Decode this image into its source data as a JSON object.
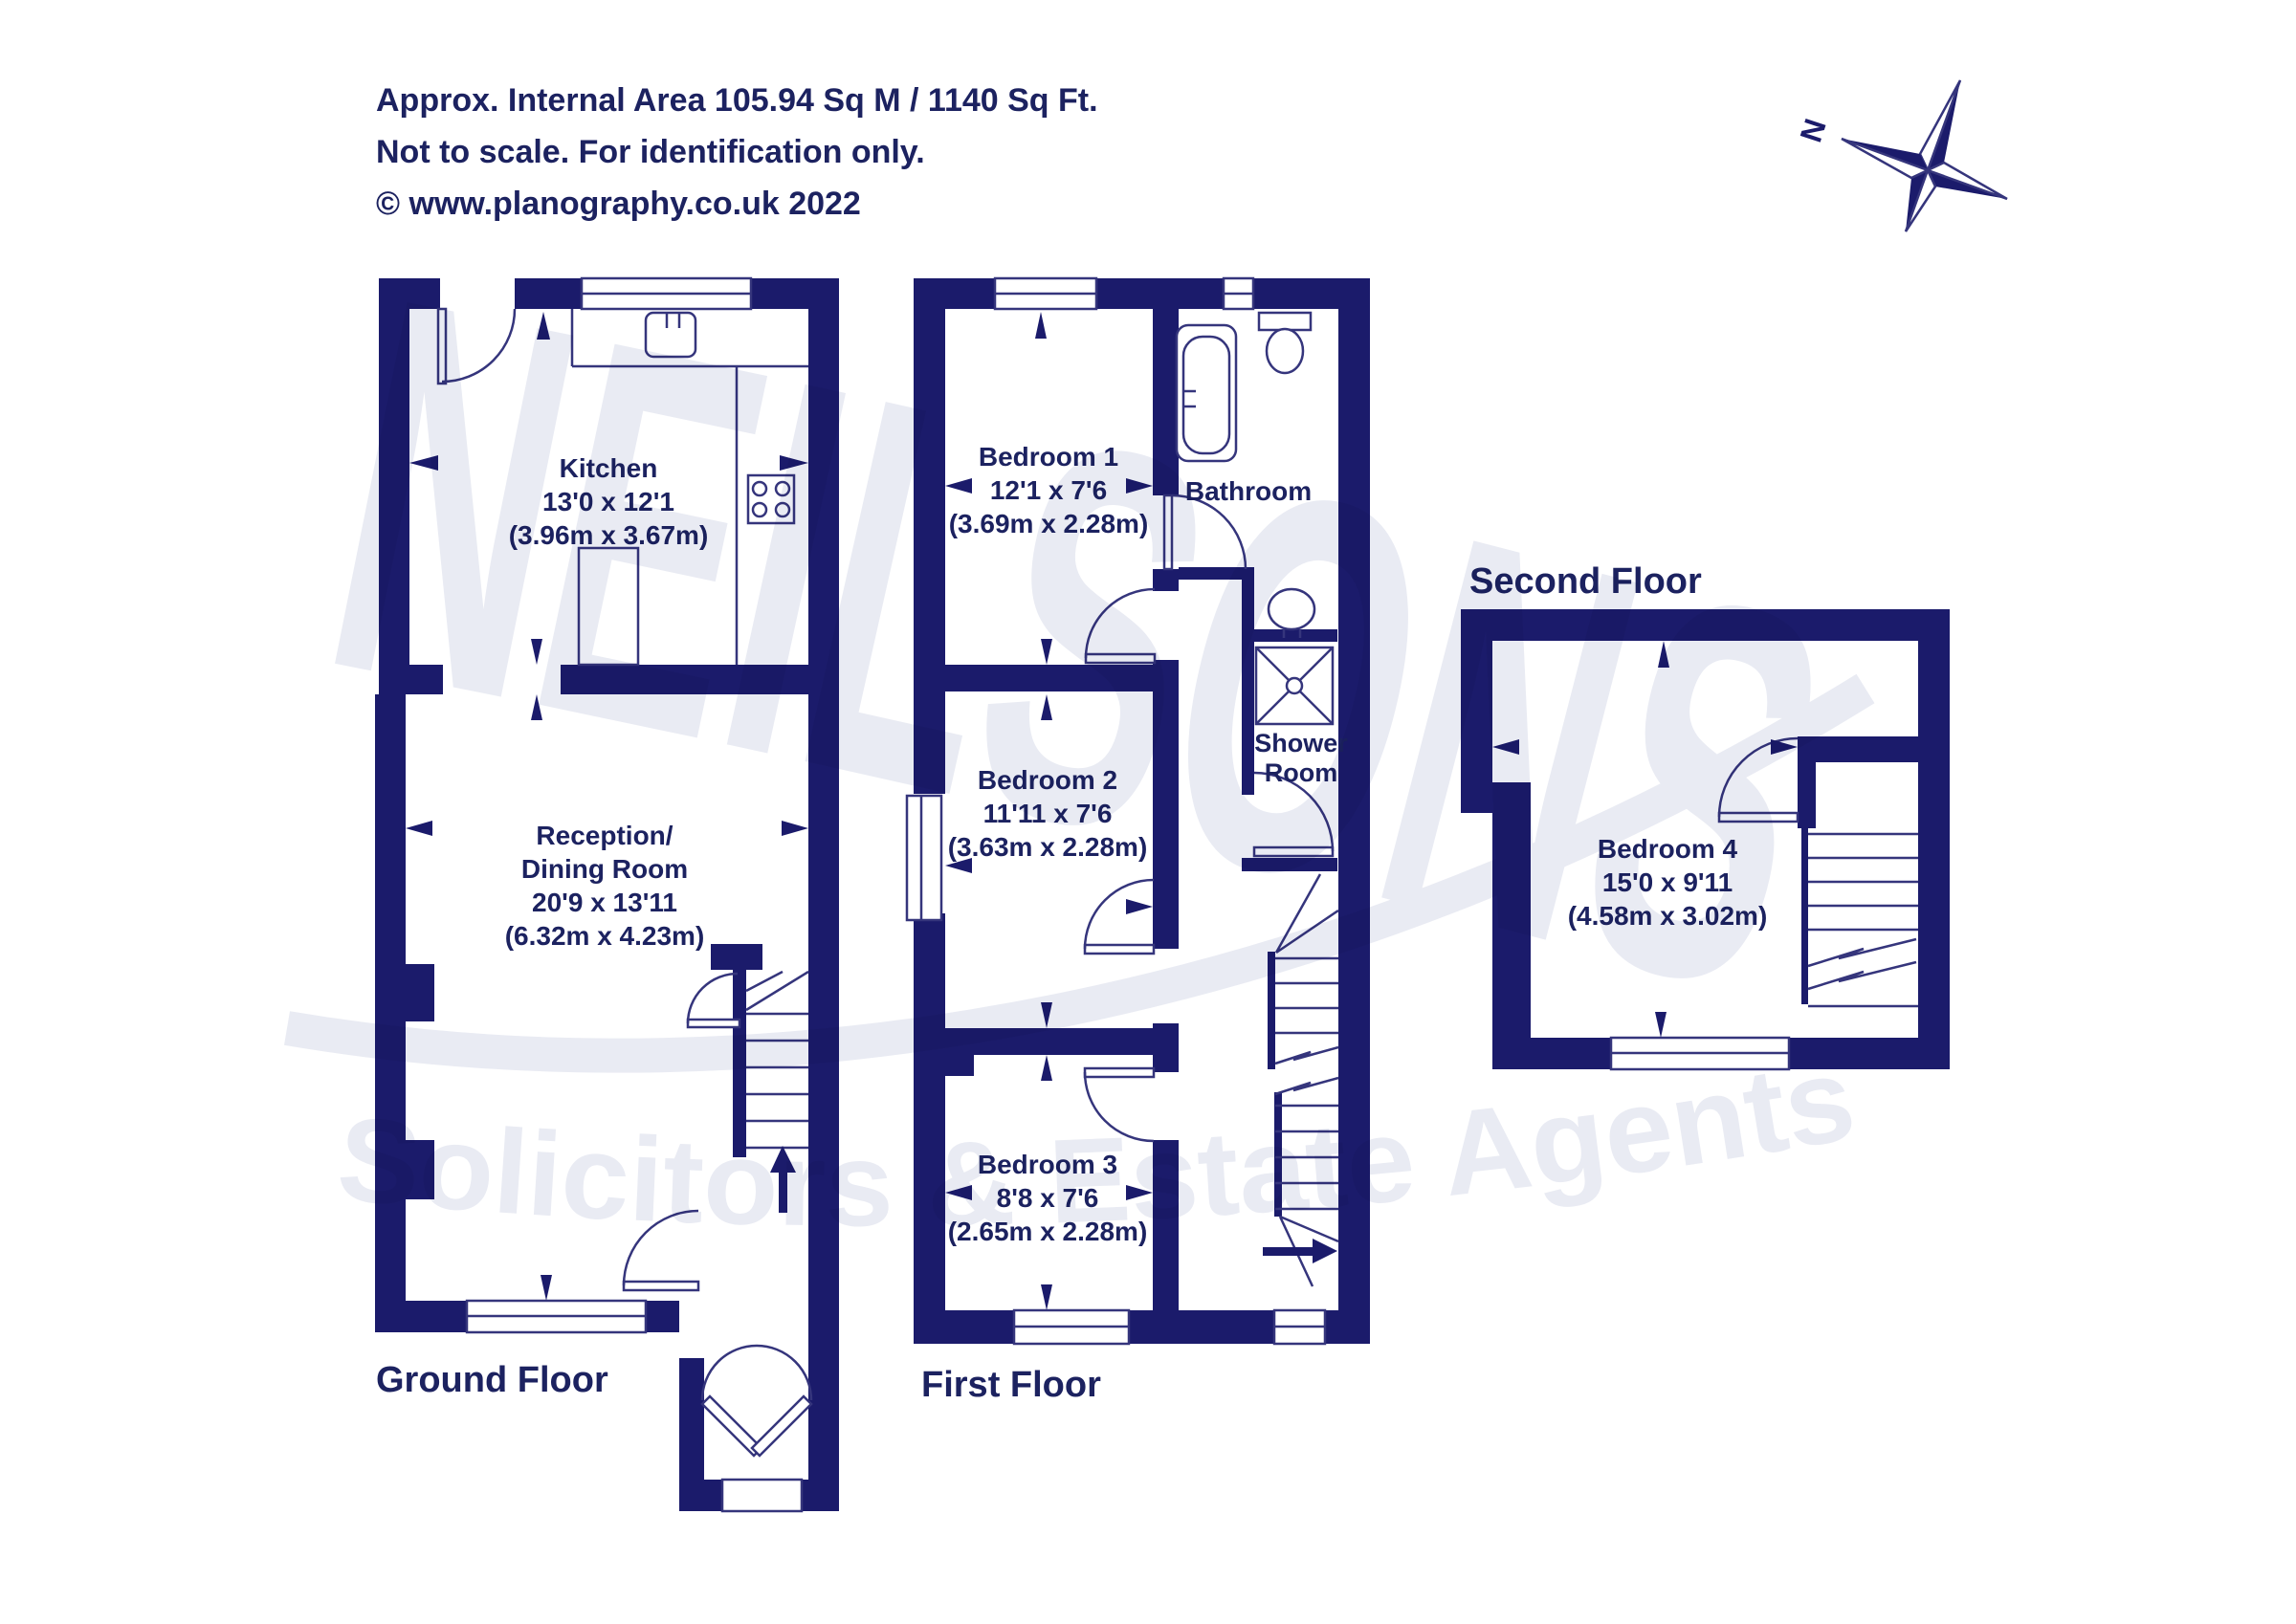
{
  "header": {
    "line1": "Approx. Internal Area 105.94 Sq M / 1140 Sq Ft.",
    "line2": "Not to scale. For identification only.",
    "line3": "© www.planography.co.uk 2022"
  },
  "compass": {
    "north_label": "N"
  },
  "watermark": {
    "name": "NEILSONS",
    "tagline": "Solicitors & Estate Agents"
  },
  "colors": {
    "wall_navy": "#1b1b6b",
    "line_navy": "#35357c",
    "text_navy": "#1c2260",
    "watermark_gray": "#e9ebf3"
  },
  "floors": {
    "ground": {
      "label": "Ground Floor",
      "rooms": {
        "kitchen": {
          "name": "Kitchen",
          "imperial": "13'0 x 12'1",
          "metric": "(3.96m x 3.67m)"
        },
        "reception": {
          "line1": "Reception/",
          "line2": "Dining Room",
          "imperial": "20'9 x 13'11",
          "metric": "(6.32m x 4.23m)"
        }
      }
    },
    "first": {
      "label": "First Floor",
      "rooms": {
        "bedroom1": {
          "name": "Bedroom 1",
          "imperial": "12'1 x 7'6",
          "metric": "(3.69m x 2.28m)"
        },
        "bathroom": {
          "name": "Bathroom"
        },
        "bedroom2": {
          "name": "Bedroom 2",
          "imperial": "11'11 x 7'6",
          "metric": "(3.63m x 2.28m)"
        },
        "shower_room": {
          "line1": "Shower",
          "line2": "Room"
        },
        "bedroom3": {
          "name": "Bedroom 3",
          "imperial": "8'8 x 7'6",
          "metric": "(2.65m x 2.28m)"
        }
      }
    },
    "second": {
      "label": "Second Floor",
      "rooms": {
        "bedroom4": {
          "name": "Bedroom 4",
          "imperial": "15'0 x 9'11",
          "metric": "(4.58m x 3.02m)"
        }
      }
    }
  }
}
